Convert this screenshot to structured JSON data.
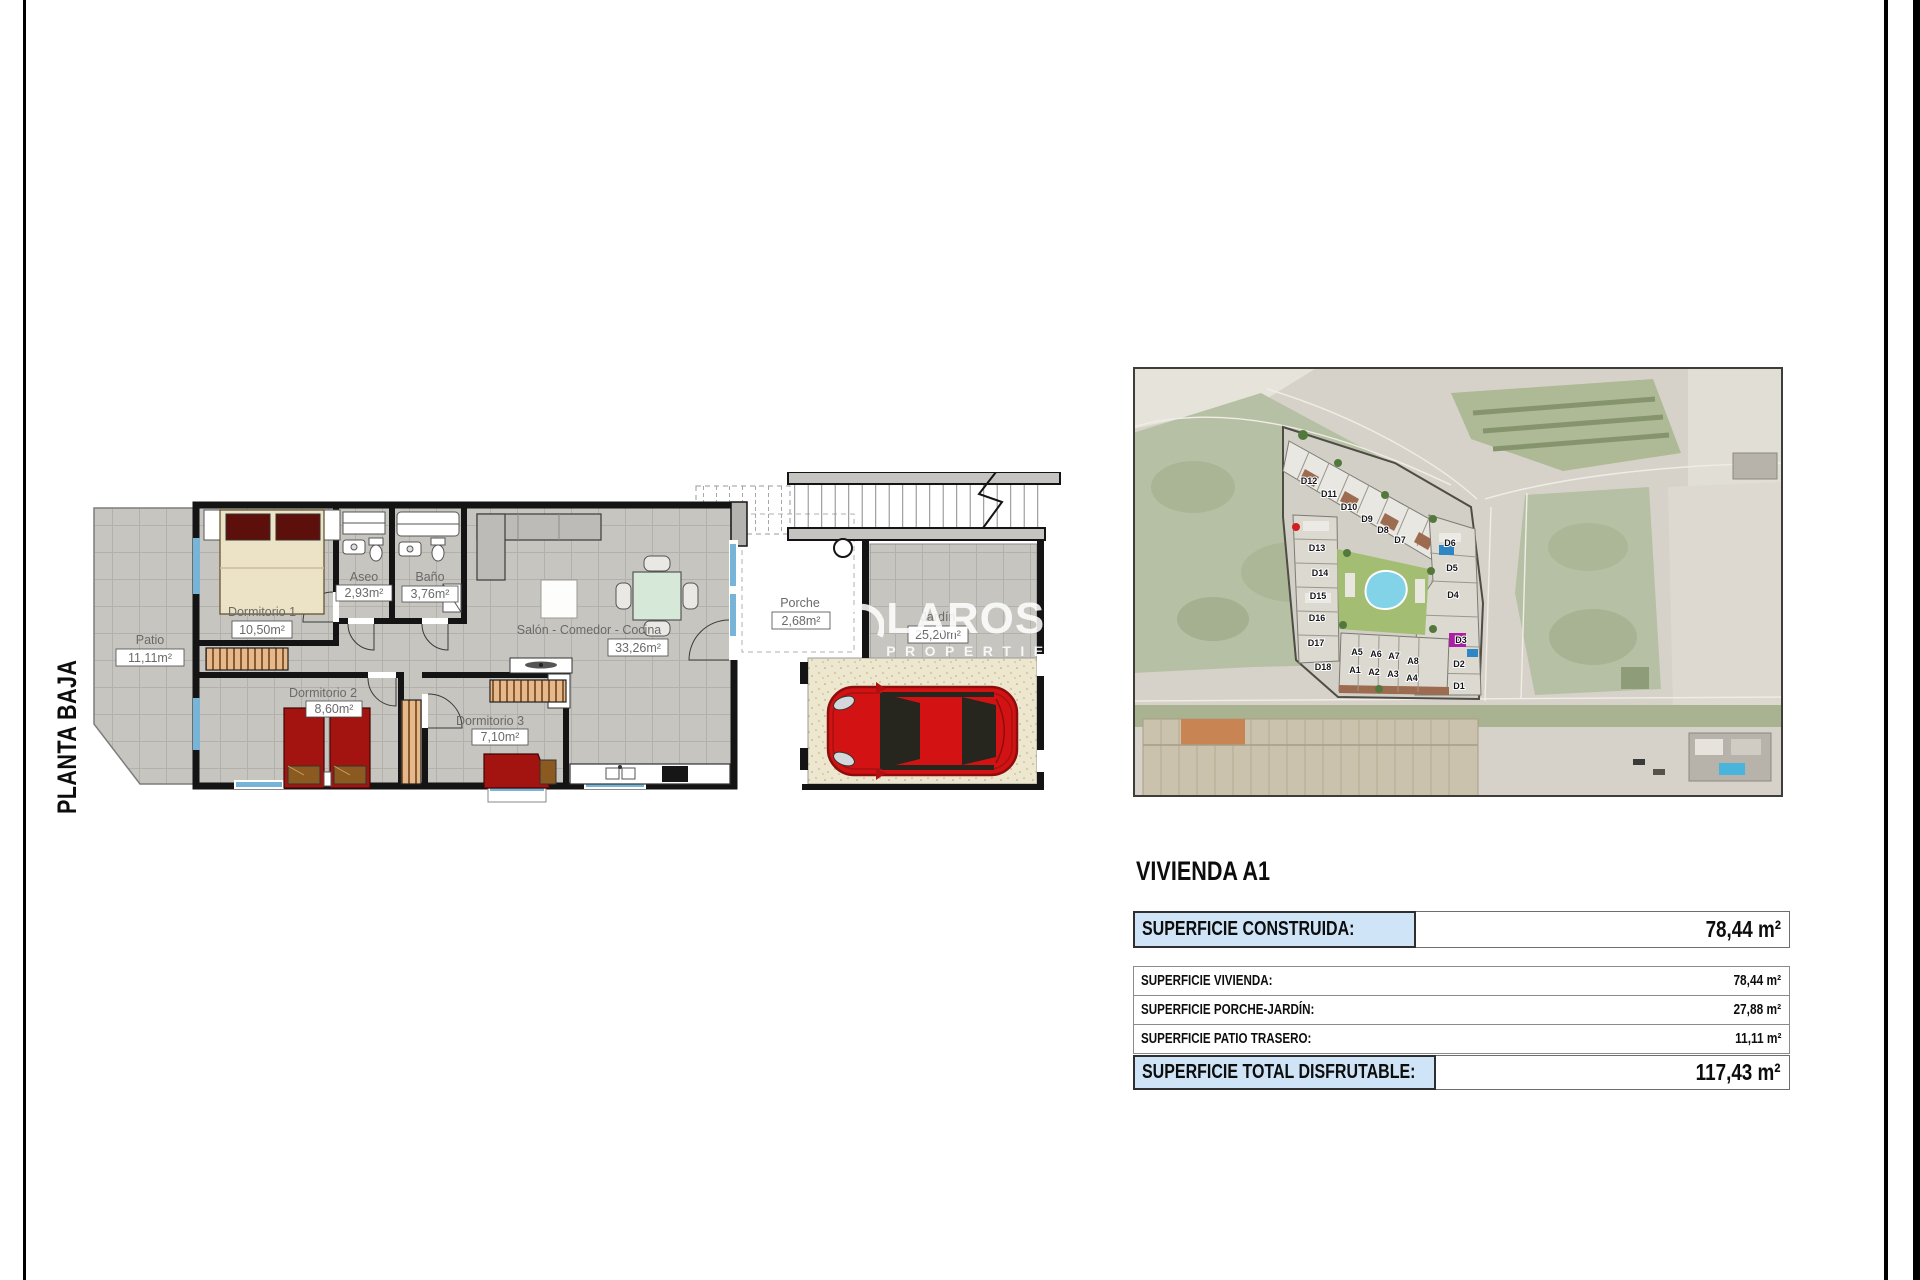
{
  "page": {
    "orientation_label": "PLANTA BAJA"
  },
  "watermark": {
    "brand": "LAROSA",
    "tagline": "PROPERTIES"
  },
  "floor_plan": {
    "rooms": [
      {
        "name": "Patio",
        "area": "11,11m²"
      },
      {
        "name": "Dormitorio 1",
        "area": "10,50m²"
      },
      {
        "name": "Aseo",
        "area": "2,93m²"
      },
      {
        "name": "Baño",
        "area": "3,76m²"
      },
      {
        "name": "Salón - Comedor - Cocina",
        "area": "33,26m²"
      },
      {
        "name": "Dormitorio 2",
        "area": "8,60m²"
      },
      {
        "name": "Dormitorio 3",
        "area": "7,10m²"
      },
      {
        "name": "Porche",
        "area": "2,68m²"
      },
      {
        "name": "Jardín",
        "area": "25,20m²"
      }
    ]
  },
  "site_map": {
    "units": [
      "D12",
      "D11",
      "D10",
      "D9",
      "D8",
      "D7",
      "D13",
      "D14",
      "D15",
      "D16",
      "D17",
      "D18",
      "D6",
      "D5",
      "D4",
      "D3",
      "D2",
      "D1",
      "A5",
      "A6",
      "A7",
      "A8",
      "A1",
      "A2",
      "A3",
      "A4"
    ]
  },
  "summary": {
    "title": "VIVIENDA A1",
    "built": {
      "label": "SUPERFICIE CONSTRUIDA:",
      "value": "78,44 m²"
    },
    "rows": [
      {
        "label": "SUPERFICIE VIVIENDA:",
        "value": "78,44 m²"
      },
      {
        "label": "SUPERFICIE PORCHE-JARDÍN:",
        "value": "27,88 m²"
      },
      {
        "label": "SUPERFICIE PATIO TRASERO:",
        "value": "11,11 m²"
      }
    ],
    "total": {
      "label": "SUPERFICIE TOTAL DISFRUTABLE:",
      "value": "117,43 m²"
    }
  },
  "colors": {
    "highlight": "#cfe4f6",
    "wall": "#141414",
    "bed_red": "#a31410",
    "pool_blue": "#82d2e8"
  }
}
